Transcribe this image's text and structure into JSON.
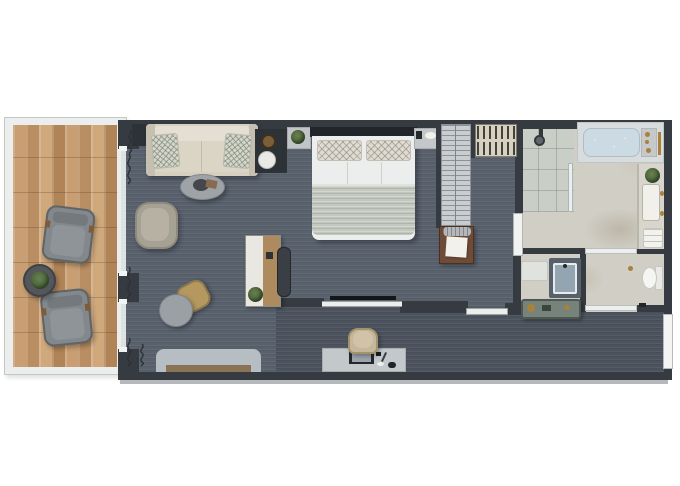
{
  "scene": {
    "type": "architectural-floor-plan",
    "description": "Top-down 3D rendered floor plan of a long hotel suite: balcony on the left, open living area and bedroom in the middle, walk-in closet, bathroom, toilet room and entry hallway on the right",
    "visible_text": ""
  },
  "labels": {
    "floor_plan": "Suite floor plan",
    "balcony": "Balcony",
    "balcony_floor": "Wood deck flooring",
    "balcony_chair": "Balcony lounge chair",
    "balcony_table": "Balcony side table with plant",
    "living": "Living area",
    "sofa": "Sofa with accent pillows",
    "sofa_cabinet": "Sofa side cabinet",
    "minibar": "Minibar cabinet with ice bucket and tray",
    "plant_shelf": "Shelf with plant",
    "coffee_table": "Coffee table with tray",
    "armchair": "Armchair",
    "stool": "Leather stool",
    "side_table": "Round side table",
    "writing_desk": "Writing desk with plant",
    "desk_chair": "Desk chair",
    "bench": "Low bench with wood tray",
    "media_desk": "Desk with laptop and accessories",
    "task_chair": "Upholstered desk chair",
    "curtain": "Curtain",
    "window": "Floor-to-ceiling window",
    "bedroom": "Bedroom",
    "bed": "King bed with patterned pillows and throw blanket",
    "nightstand": "Nightstand with lamp",
    "tv": "Wall-mounted TV",
    "glass_partition": "Glass partition",
    "closet": "Closet rail with hangers",
    "wardrobe": "Open shelving unit",
    "luggage_bench": "Luggage bench with towel and basket",
    "bathroom": "Bathroom",
    "bathroom_door": "Bathroom door",
    "shower": "Walk-in shower",
    "shower_head": "Rain shower head",
    "bathtub": "Bathtub",
    "vanity": "Vanity counter with washbasin",
    "vanity_plant": "Plant",
    "towels": "Folded towels",
    "bath_mat": "Bath mat",
    "sink": "Washbasin counter",
    "toilet_room": "Toilet room",
    "toilet": "Toilet",
    "sliding_door": "Sliding door",
    "hallway": "Entry hallway",
    "console": "Hallway console with accessories",
    "entry_door": "Entry door"
  },
  "palette": {
    "wall": "#363b41",
    "carpet": "#59616d",
    "hallway_carpet": "#4c535e",
    "wood_deck": "#c09468",
    "marble": "#d0cec5",
    "shower_tile": "#c9cec7",
    "sofa_fabric": "#d6d0c1",
    "blanket": "#c4c9c0",
    "tub_water": "#ccdae3",
    "brass": "#a8813c",
    "greenery": "#4c6a3e",
    "console_green": "#76837a",
    "glass": "#dde2e3",
    "fixture_white": "#f2f2ee"
  }
}
